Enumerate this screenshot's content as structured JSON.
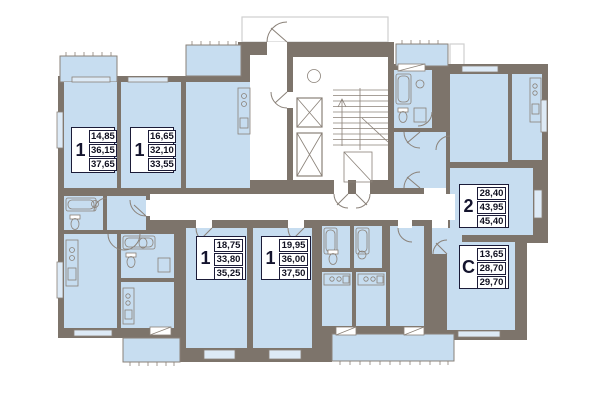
{
  "plan_name": "residential-floor-plan",
  "apartments": [
    {
      "id": "apt-1",
      "type": "1",
      "areas": [
        "14,85",
        "36,15",
        "37,65"
      ]
    },
    {
      "id": "apt-2",
      "type": "1",
      "areas": [
        "16,65",
        "32,10",
        "33,55"
      ]
    },
    {
      "id": "apt-3",
      "type": "1",
      "areas": [
        "18,75",
        "33,80",
        "35,25"
      ]
    },
    {
      "id": "apt-4",
      "type": "1",
      "areas": [
        "19,95",
        "36,00",
        "37,50"
      ]
    },
    {
      "id": "apt-5",
      "type": "2",
      "areas": [
        "28,40",
        "43,95",
        "45,40"
      ]
    },
    {
      "id": "apt-6",
      "type": "C",
      "areas": [
        "13,65",
        "28,70",
        "29,70"
      ]
    }
  ],
  "colors": {
    "wall": "#7d746b",
    "room": "#c7ddf0",
    "line": "#8a8178",
    "window": "#ddeaf6",
    "label": "#1b1b38"
  },
  "icons": [
    "elevator-icon",
    "stairs-icon",
    "garbage-chute-icon",
    "door-swing-icon",
    "bathtub-icon",
    "toilet-icon",
    "sink-icon",
    "stove-icon",
    "balcony-railing-icon"
  ]
}
